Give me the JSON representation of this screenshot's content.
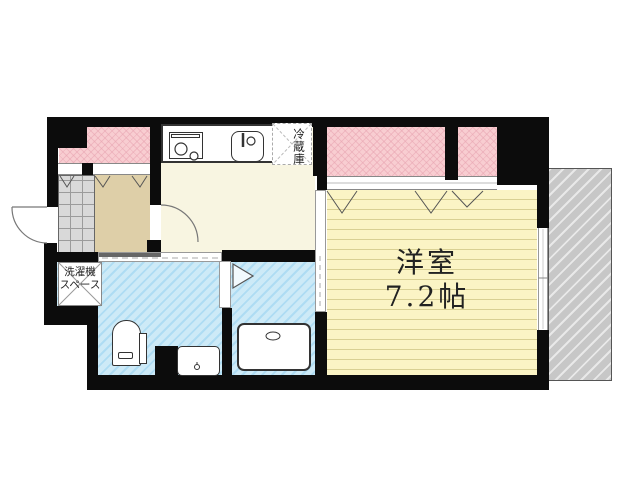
{
  "floorplan": {
    "bedroom": {
      "name": "洋室",
      "size": "7.2帖"
    },
    "refrigerator": {
      "label": "冷蔵庫"
    },
    "washer": {
      "line1": "洗濯機",
      "line2": "スペース"
    },
    "fixtures": [
      "stove",
      "kitchen-sink",
      "refrigerator-space",
      "washing-machine-space",
      "toilet",
      "washbasin",
      "bathtub",
      "entrance-door",
      "kitchen-door",
      "bathroom-folding-door",
      "sliding-doors",
      "windows"
    ],
    "colors": {
      "wall": "#0c0c0c",
      "balcony_pink": "#f8cdd1",
      "bedroom_yellow": "#fbf4c5",
      "kitchen_cream": "#f8f5e1",
      "hall_beige": "#decfa8",
      "wet_area_blue": "#cdeaf7",
      "entrance_tile_gray": "#d9d9d9",
      "adjacent_structure_gray": "#c7c7c7"
    }
  }
}
